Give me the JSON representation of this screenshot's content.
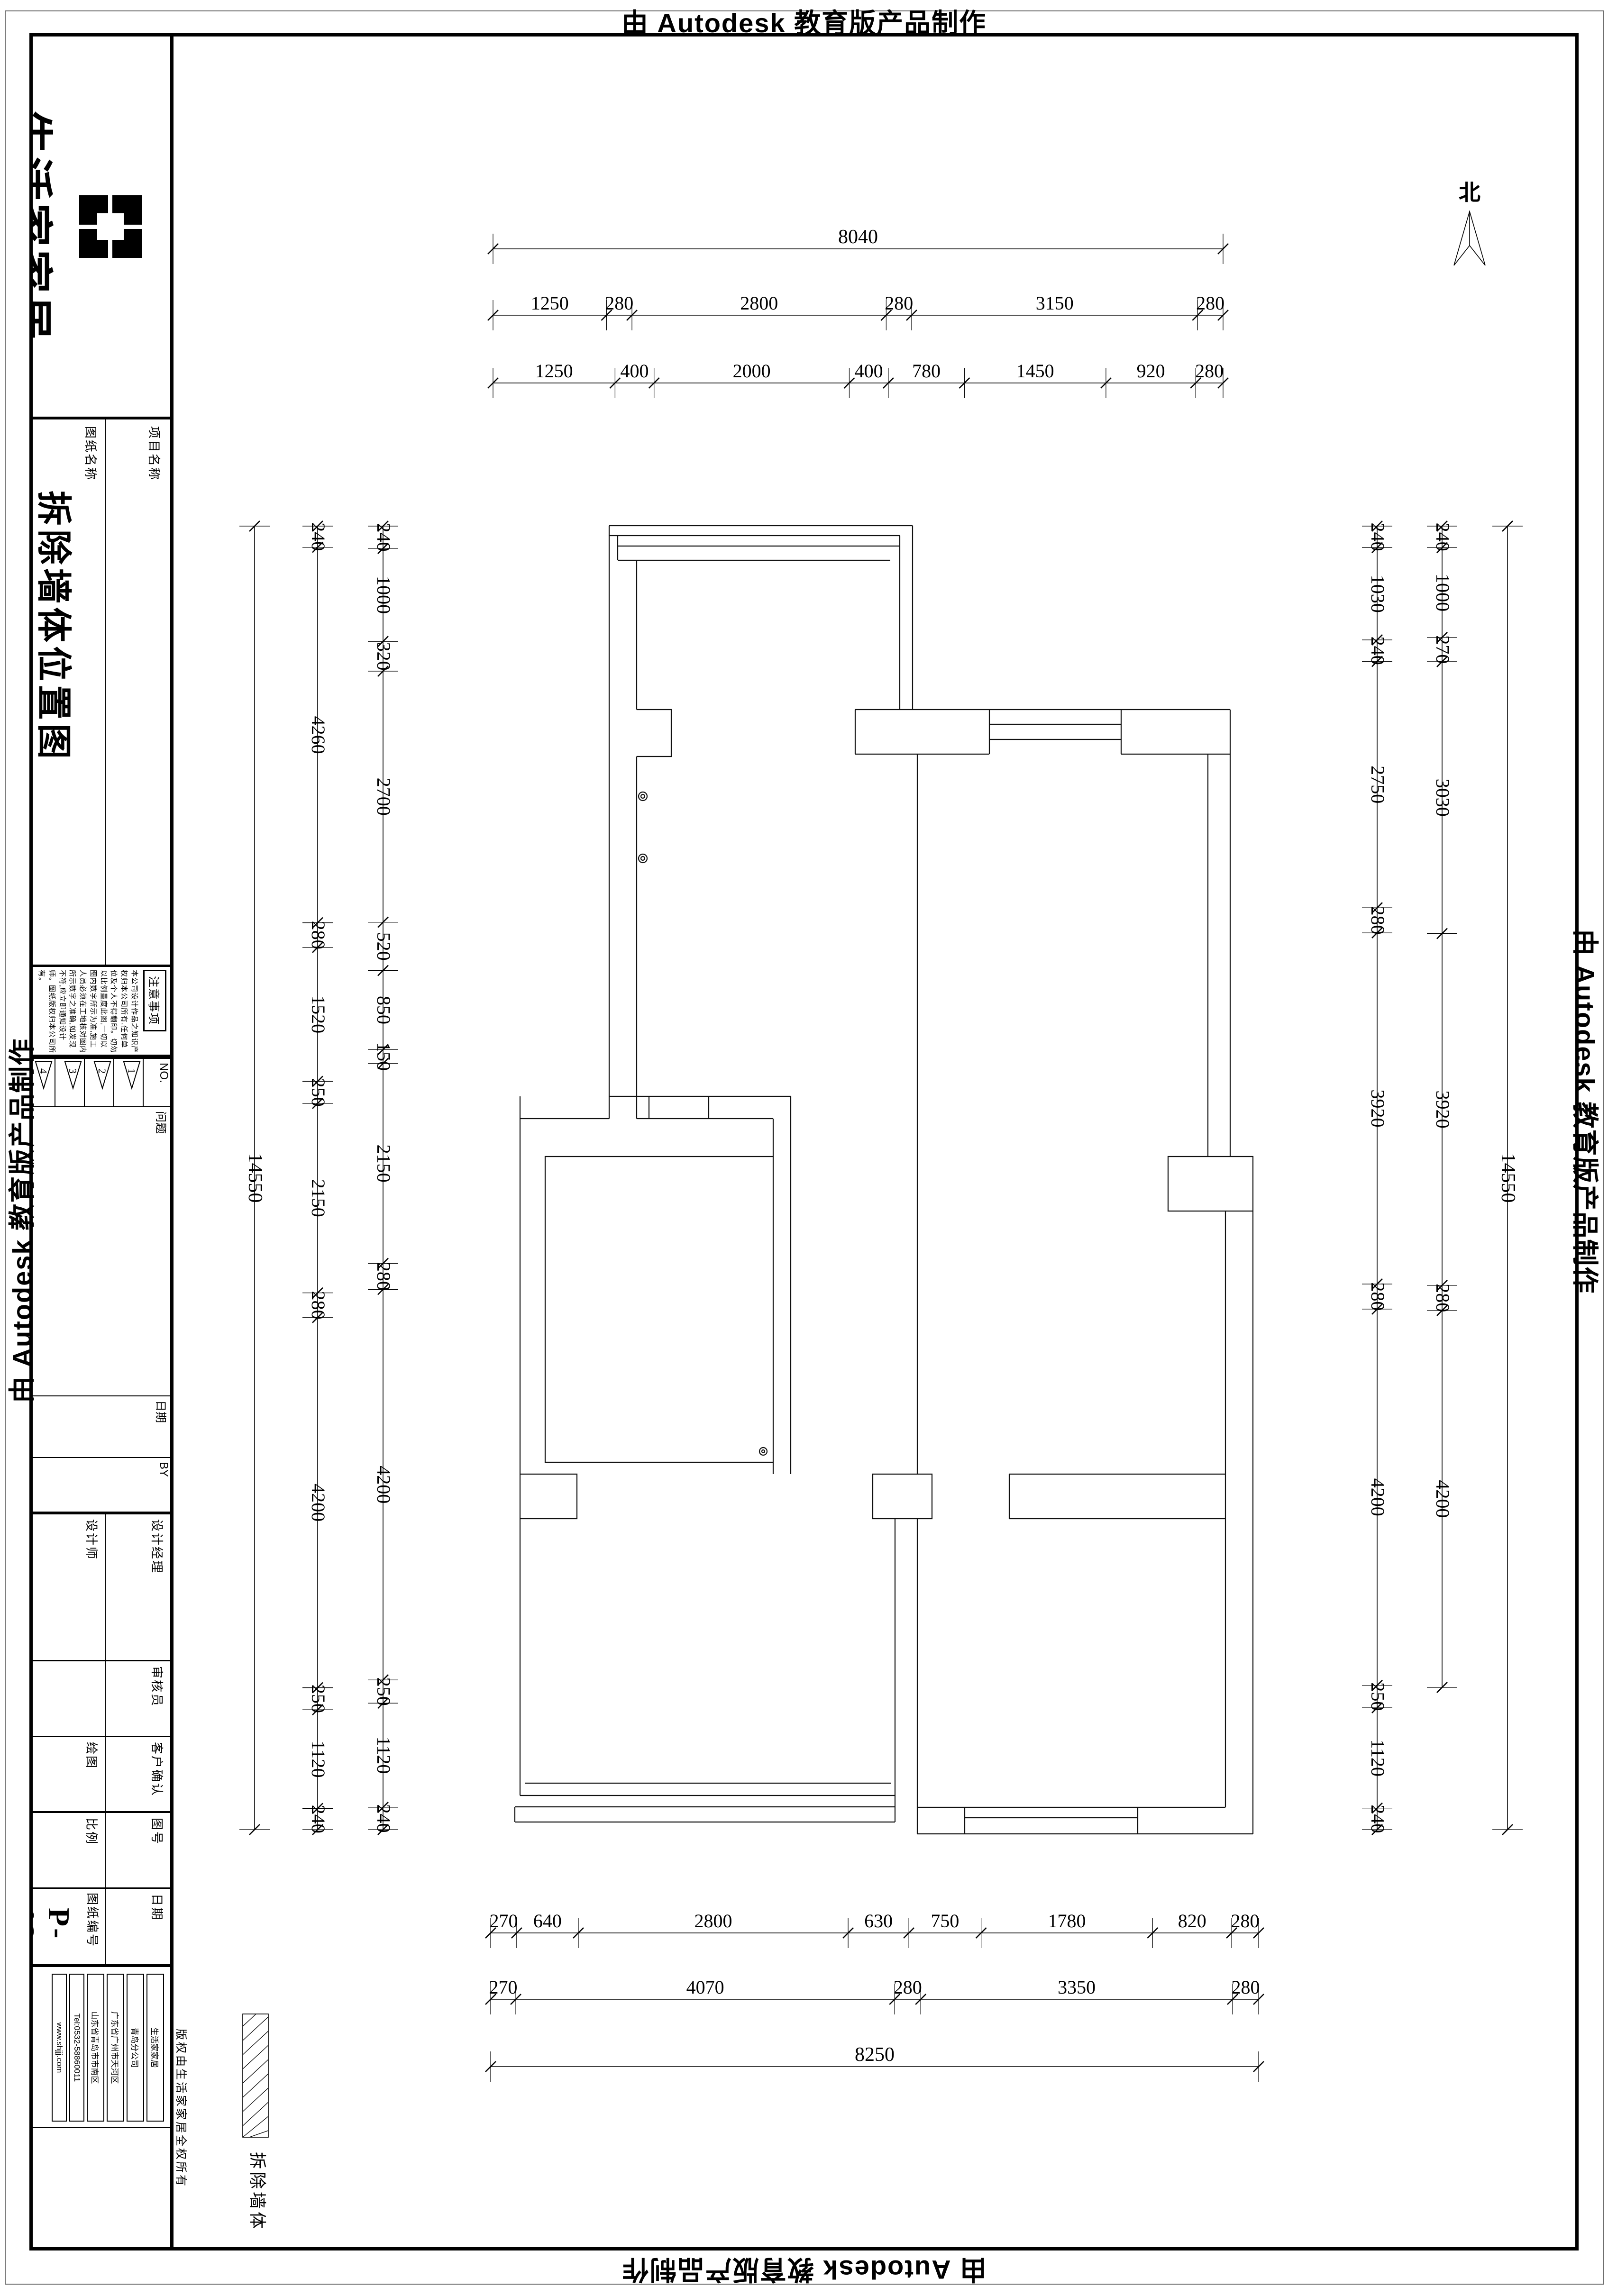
{
  "banner": {
    "text": "由 Autodesk 教育版产品制作"
  },
  "north": {
    "label": "北"
  },
  "legend": {
    "label": "拆除墙体"
  },
  "title_block": {
    "brand": "生活家家居",
    "tagline": "【健康生活服务商】",
    "project_label": "项目名称",
    "drawing_label": "图纸名称",
    "drawing_title": "拆除墙体位置图",
    "notes_title": "注意事项",
    "notes_body": "本公司设计作品之知识产权归本公司所有,任何单位及个人不得翻印。切勿以比例量度此图,一切以图内数字所示为准,施工人员必须在工地核对图内所示数字之准确,如发现不符,应立即通知设计师。图纸版权归本公司所有。",
    "revision": {
      "no_label": "NO.",
      "issue_label": "问题",
      "date_label": "日期",
      "by_label": "BY",
      "marks": [
        "1",
        "2",
        "3",
        "4"
      ]
    },
    "rows": [
      {
        "left": "设计师",
        "right": "设计经理"
      },
      {
        "left": "",
        "right": "审核员"
      },
      {
        "left": "绘图",
        "right": "客户确认"
      },
      {
        "left": "比例",
        "right": "图号"
      },
      {
        "left": "图纸编号",
        "right": "日期"
      }
    ],
    "drawing_no": "P-02",
    "company_boxes": [
      "生活家家居",
      "青岛分公司",
      "广东省广州市天河区",
      "山东省青岛市市南区",
      "Tel:0532-58860011",
      "www.shjjj.com"
    ],
    "copyright": "版权由生活家家居全权所有"
  },
  "dims": {
    "top": [
      [
        8040
      ],
      [
        1250,
        280,
        2800,
        280,
        3150,
        280
      ],
      [
        1250,
        400,
        2000,
        400,
        780,
        1450,
        920,
        280
      ]
    ],
    "bottom": [
      [
        270,
        640,
        2800,
        630,
        750,
        1780,
        820,
        280
      ],
      [
        270,
        4070,
        280,
        3350,
        280
      ],
      [
        8250
      ]
    ],
    "left": [
      [
        14550
      ],
      [
        240,
        4260,
        280,
        1520,
        250,
        2150,
        280,
        4200,
        250,
        1120,
        240
      ],
      [
        240,
        1000,
        320,
        2700,
        520,
        850,
        150,
        2150,
        280,
        4200,
        250,
        1120,
        240
      ]
    ],
    "right": [
      [
        240,
        1030,
        240,
        2750,
        280,
        3920,
        280,
        4200,
        250,
        1120,
        240
      ],
      [
        240,
        1000,
        270,
        3030,
        3920,
        280,
        4200
      ],
      [
        14550
      ]
    ]
  }
}
